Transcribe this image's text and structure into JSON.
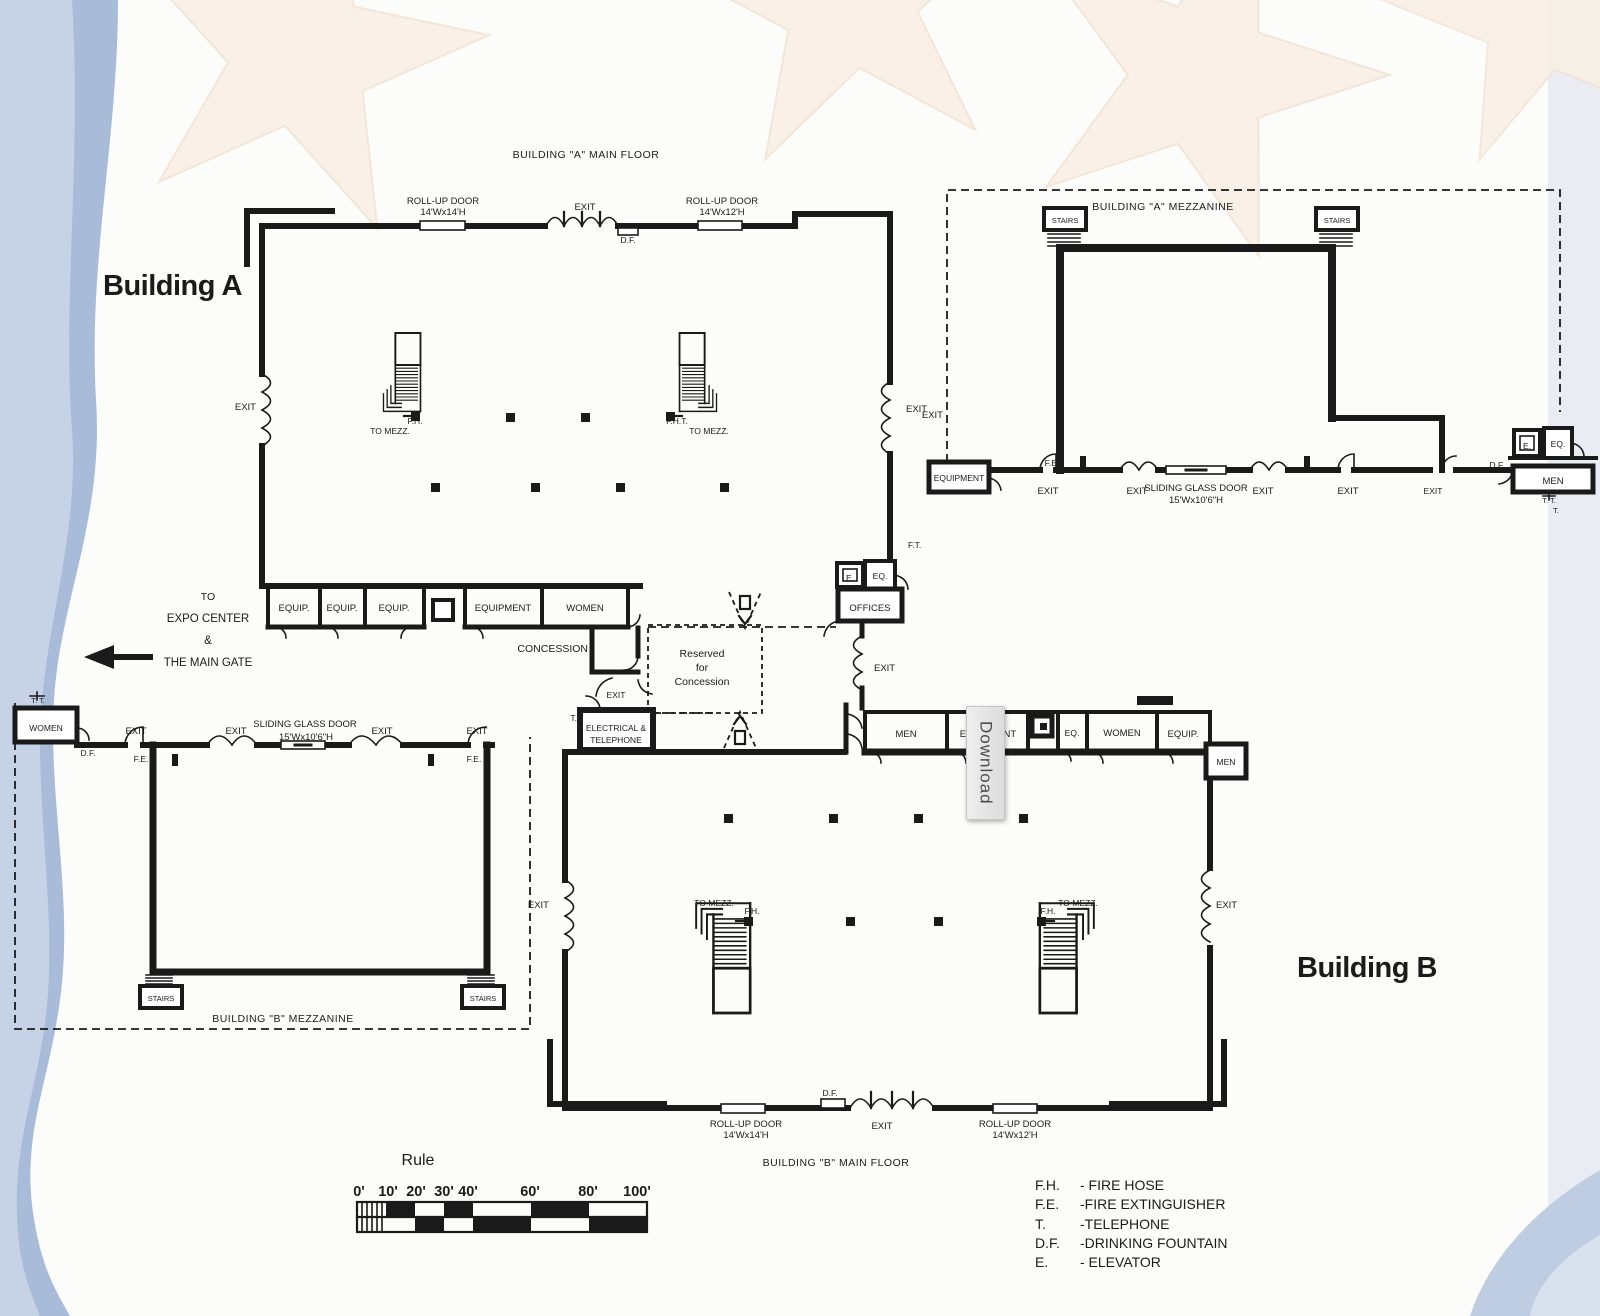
{
  "window": {
    "download_label": "Download"
  },
  "titles": {
    "building_a": "Building A",
    "building_b": "Building B",
    "a_main_floor": "BUILDING \"A\" MAIN FLOOR",
    "a_mezzanine": "BUILDING \"A\" MEZZANINE",
    "b_mezzanine": "BUILDING \"B\" MEZZANINE",
    "b_main_floor": "BUILDING \"B\" MAIN FLOOR"
  },
  "labels": {
    "exit": "EXIT",
    "roll_up_door": "ROLL-UP DOOR",
    "door_14x14": "14'Wx14'H",
    "door_14x12": "14'Wx12'H",
    "sliding_glass_door": "SLIDING GLASS DOOR",
    "sgd_size": "15'Wx10'6\"H",
    "df": "D.F.",
    "fe": "F.E.",
    "fh": "F.H.",
    "fht": "F.H.T.",
    "ft": "F.T.",
    "t": "T.",
    "tt": "T. T.",
    "e": "E.",
    "eq": "EQ.",
    "equip": "EQUIP.",
    "equipment": "EQUIPMENT",
    "women": "WOMEN",
    "men": "MEN",
    "stairs": "STAIRS",
    "offices": "OFFICES",
    "concession": "CONCESSION",
    "to_mezz": "TO MEZZ.",
    "electrical_line1": "ELECTRICAL &",
    "electrical_line2": "TELEPHONE",
    "reserved_line1": "Reserved",
    "reserved_line2": "for",
    "reserved_line3": "Concession"
  },
  "expo": {
    "line1": "TO",
    "line2": "EXPO CENTER",
    "line3": "&",
    "line4": "THE MAIN GATE"
  },
  "rule": {
    "title": "Rule",
    "ticks": [
      "0'",
      "10'",
      "20'",
      "30'",
      "40'",
      "60'",
      "80'",
      "100'"
    ]
  },
  "legend": {
    "entries": [
      {
        "abbr": "F.H.",
        "name": "- FIRE HOSE"
      },
      {
        "abbr": "F.E.",
        "name": "-FIRE EXTINGUISHER"
      },
      {
        "abbr": "T.",
        "name": "-TELEPHONE"
      },
      {
        "abbr": "D.F.",
        "name": "-DRINKING FOUNTAIN"
      },
      {
        "abbr": "E.",
        "name": "- ELEVATOR"
      }
    ]
  }
}
